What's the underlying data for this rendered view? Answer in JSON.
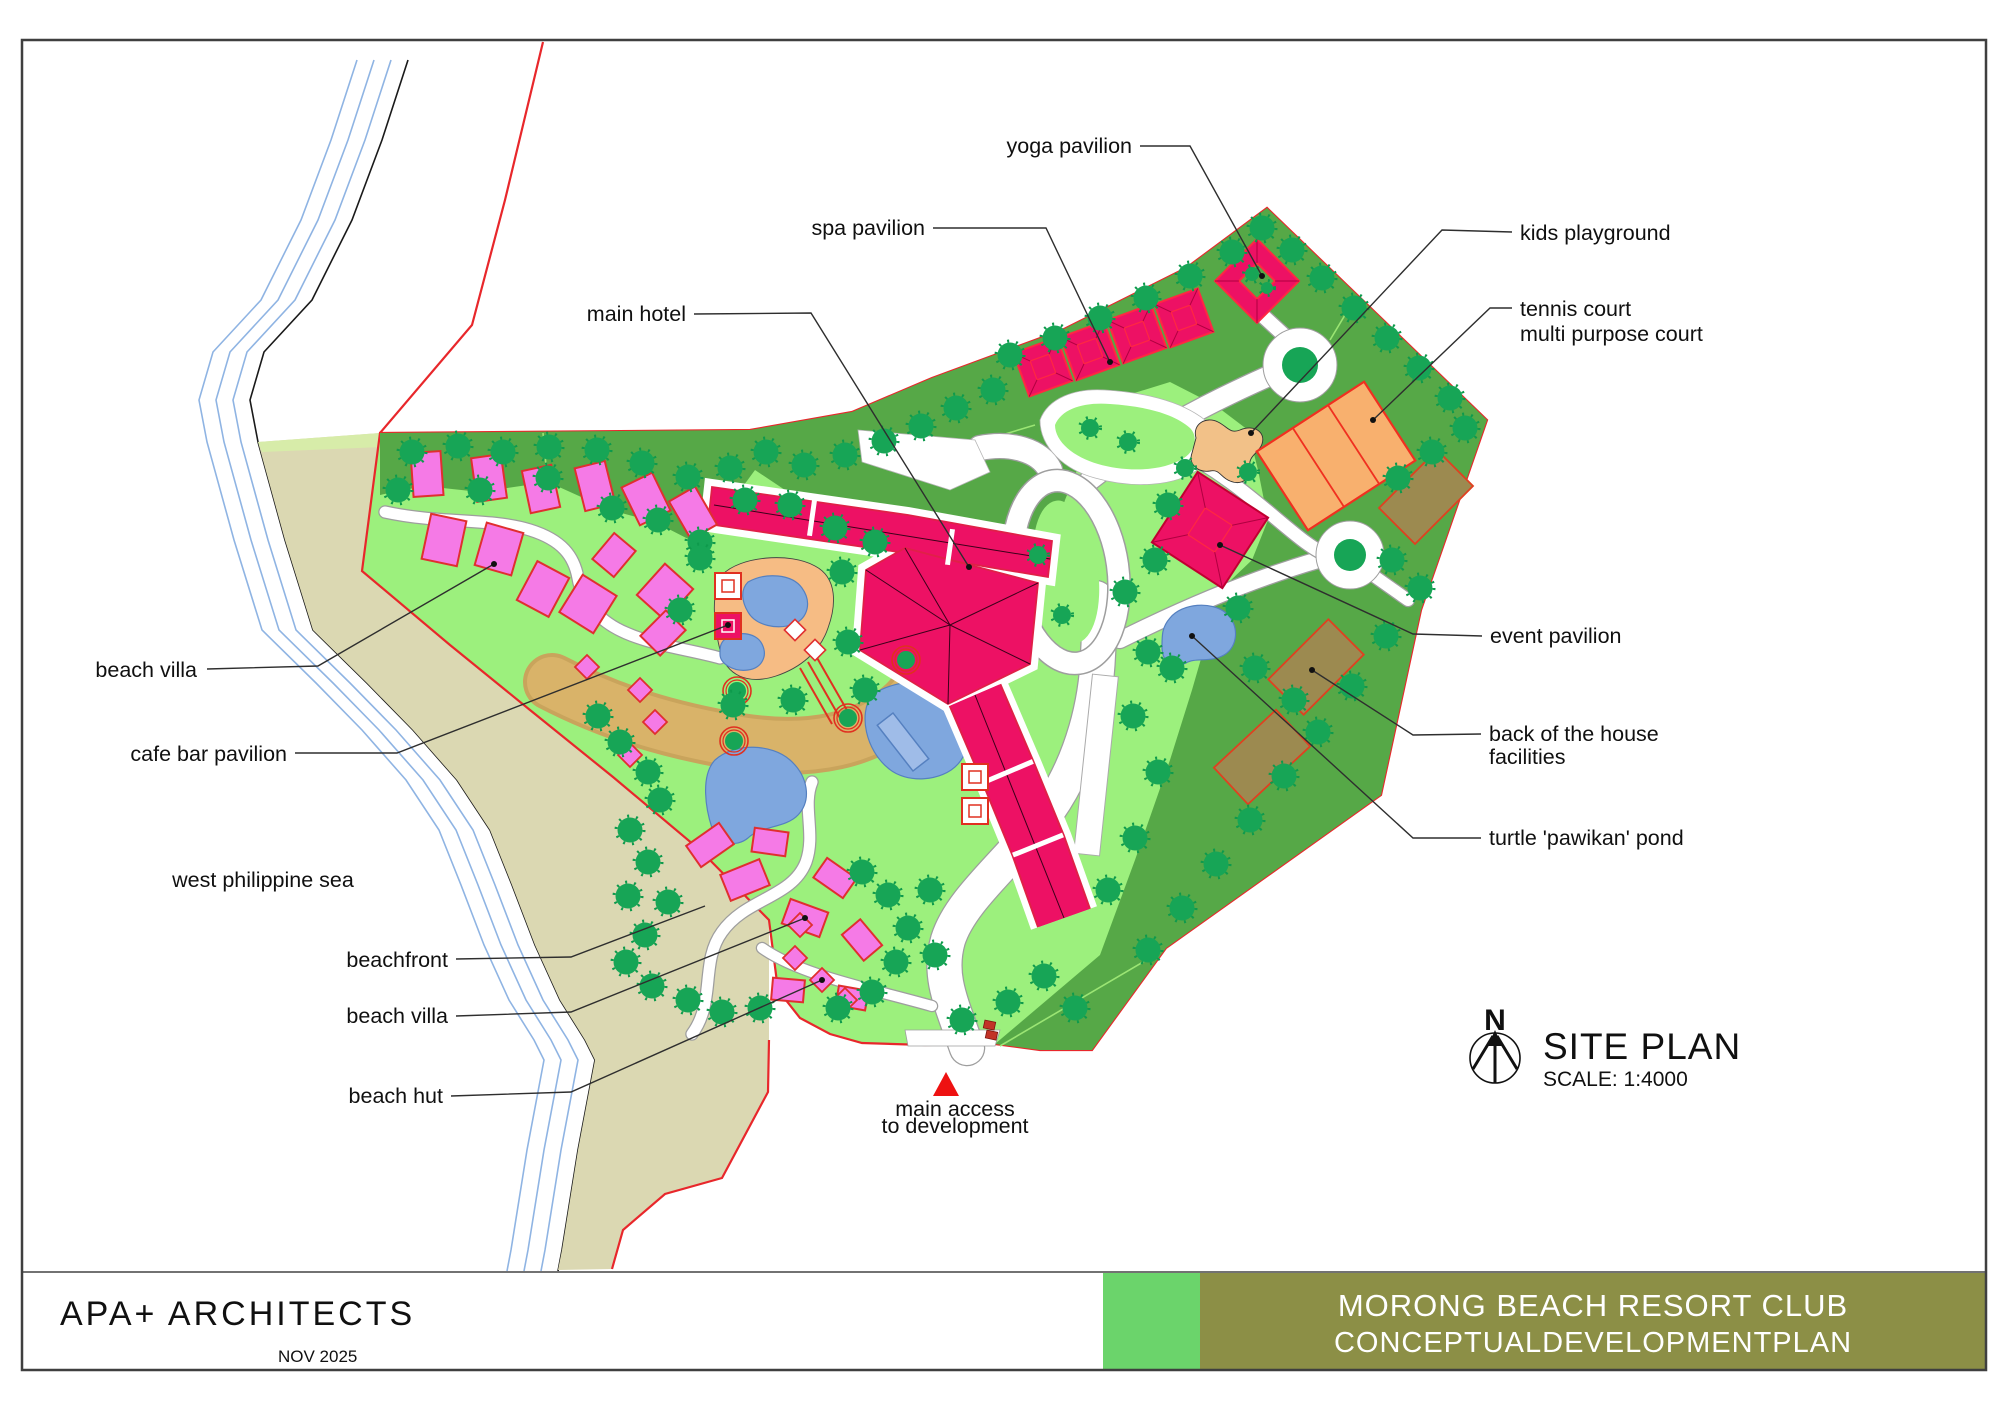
{
  "document": {
    "plan_name": "SITE PLAN",
    "scale": "SCALE: 1:4000",
    "north_symbol": "N",
    "firm": "APA+ ARCHITECTS",
    "date": "NOV 2025",
    "title_line1": "MORONG BEACH RESORT CLUB",
    "title_line2": "CONCEPTUALDEVELOPMENTPLAN"
  },
  "annotations": [
    {
      "id": "yoga-pavilion",
      "lines": [
        "yoga pavilion"
      ]
    },
    {
      "id": "spa-pavilion",
      "lines": [
        "spa pavilion"
      ]
    },
    {
      "id": "main-hotel",
      "lines": [
        "main hotel"
      ]
    },
    {
      "id": "kids-playground",
      "lines": [
        "kids playground"
      ]
    },
    {
      "id": "tennis-court",
      "lines": [
        "tennis court",
        "multi purpose court"
      ]
    },
    {
      "id": "event-pavilion",
      "lines": [
        "event pavilion"
      ]
    },
    {
      "id": "back-of-house",
      "lines": [
        "back of the house",
        "facilities"
      ]
    },
    {
      "id": "turtle-pond",
      "lines": [
        "turtle 'pawikan' pond"
      ]
    },
    {
      "id": "beach-villa-upper",
      "lines": [
        "beach villa"
      ]
    },
    {
      "id": "cafe-bar-pavilion",
      "lines": [
        "cafe bar pavilion"
      ]
    },
    {
      "id": "west-philippine-sea",
      "lines": [
        "west philippine sea"
      ]
    },
    {
      "id": "beachfront",
      "lines": [
        "beachfront"
      ]
    },
    {
      "id": "beach-villa-lower",
      "lines": [
        "beach villa"
      ]
    },
    {
      "id": "beach-hut",
      "lines": [
        "beach hut"
      ]
    },
    {
      "id": "main-access",
      "lines": [
        "main access",
        "to development"
      ]
    }
  ],
  "colors": {
    "site_lawn": "#9CF07D",
    "perimeter_green": "#56A847",
    "tree_green": "#17A556",
    "building_crimson": "#ED1164",
    "villa_pink": "#F57AE6",
    "boundary_red": "#E8272B",
    "court_orange": "#F8B06E",
    "back_of_house_brown": "#9C8A50",
    "water_blue": "#7FA7DE",
    "beach_sand": "#DBD8B2",
    "deck_sand": "#F6BC84",
    "creek_tan": "#D9B369",
    "titlebar_olive": "#8C8F46",
    "titlebar_green": "#6BD46B"
  }
}
